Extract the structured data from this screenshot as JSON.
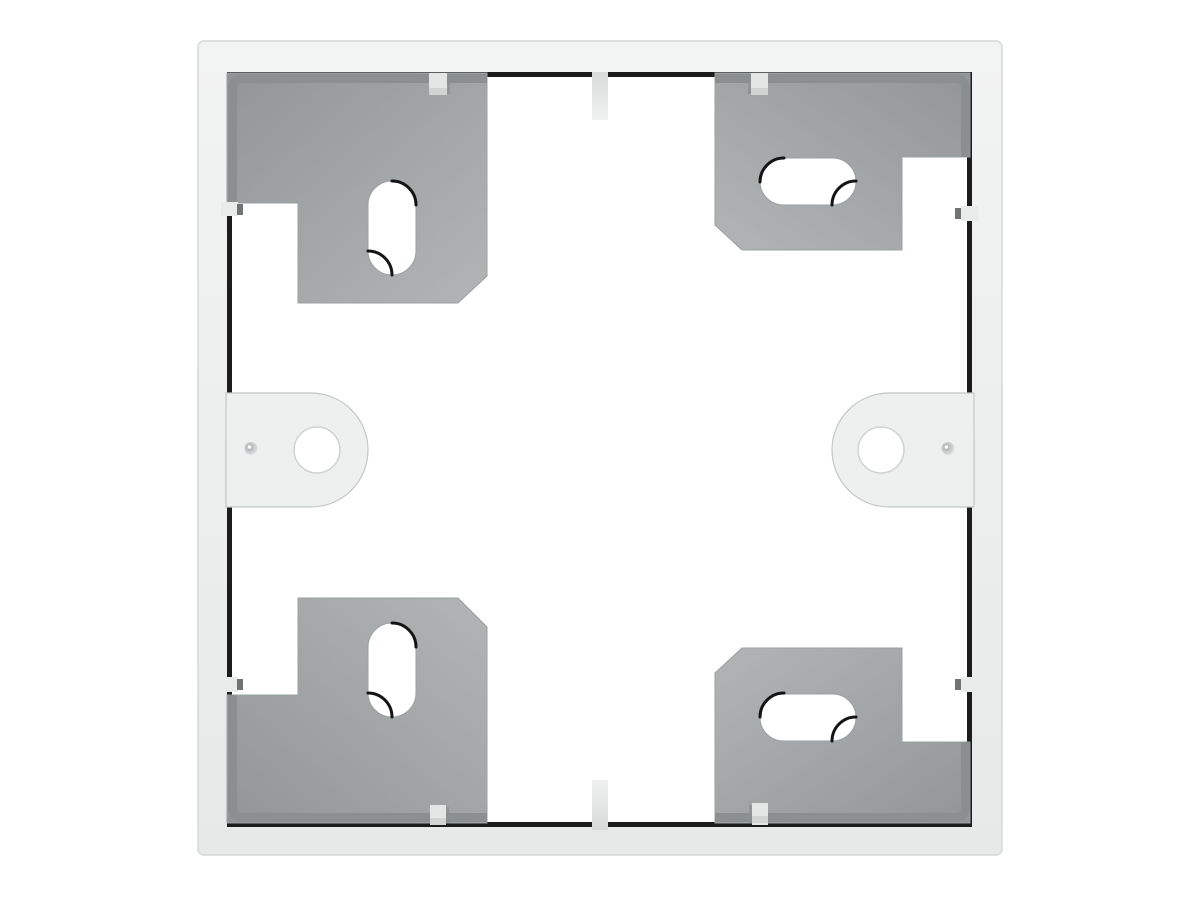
{
  "scene": {
    "subject": "Front view product photo of a white square surface-mount wall box frame with gray corner mounting plates",
    "background": "#ffffff"
  },
  "palette": {
    "background": "#ffffff",
    "frame_top": "#f2f3f3",
    "frame_bottom": "#e7e9e9",
    "frame_edge": "#d6d8d8",
    "cavity": "#ffffff",
    "lip_shadow": "#1c1c1c",
    "plate_dark": "#929696",
    "plate_light": "#b2b5b5",
    "plate_bevel": "#8b8f8f",
    "plate_outline": "#9aa0a0",
    "slot_fill": "#ffffff",
    "slot_shadow": "#141414",
    "tab_fill": "#eef0f0",
    "tab_outline": "#c4c7c7",
    "hole_fill": "#ffffff",
    "hole_outline": "#d0d3d3",
    "dimple_dark": "#a4a8a8",
    "dimple_highlight": "#fbfcfc",
    "clip_light": "#e9ebeb",
    "clip_dark": "#6f7373",
    "notch_dark": "#d8dada",
    "notch_light": "#f0f1f1",
    "plate_clip": "#e4e6e6",
    "plate_clip_shade": "#d2d4d4",
    "plate_clip_shadow": "#8a8e8e"
  },
  "components": {
    "mounting_plates": 4,
    "cable_slots": 4,
    "screw_tabs": 2,
    "screw_holes": 2,
    "alignment_notches": 2,
    "side_clips": 4,
    "retainer_clips": 4
  }
}
